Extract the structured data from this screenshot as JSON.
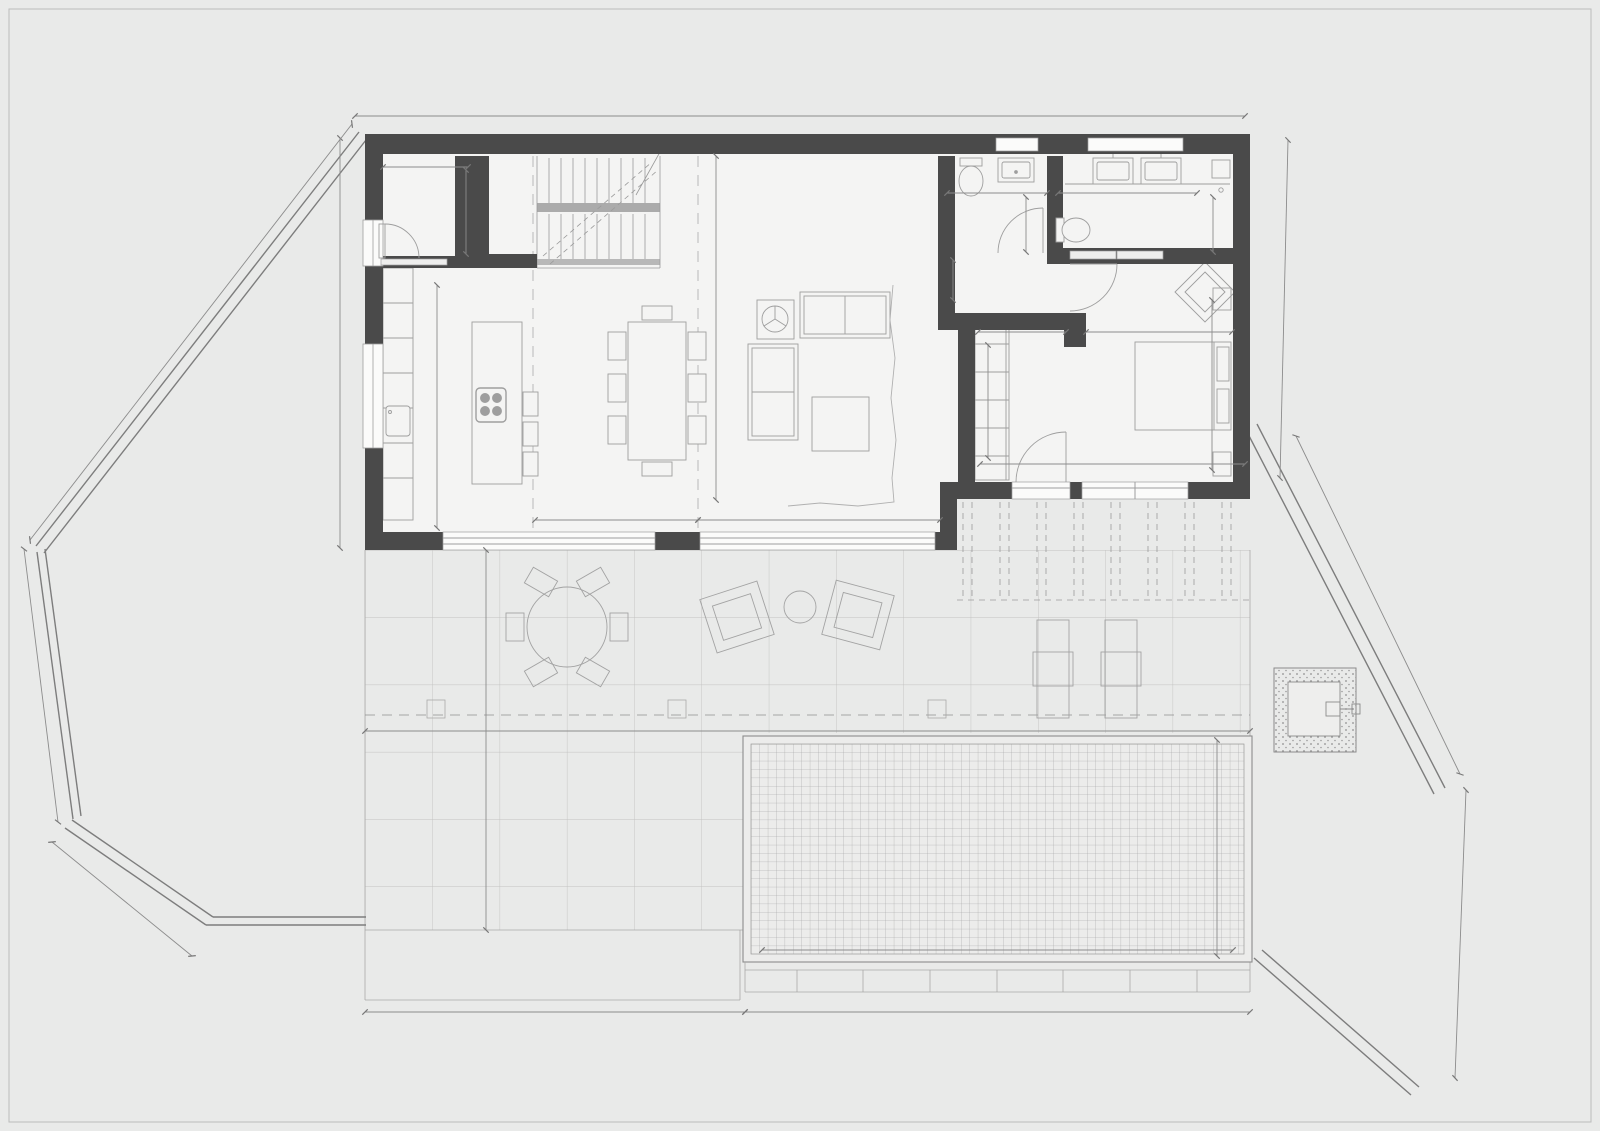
{
  "title": {
    "name": "PLANTA BAJA",
    "line1": "Sup. construida vivienda 122,3 m²",
    "line2": "Sup. construida porche 29,40 m² (computable 14,70 m²)"
  },
  "colors": {
    "title_accent": "#44708f",
    "wall": "#4a4a4a"
  },
  "rooms": {
    "despensa": {
      "name": "Despensa",
      "area": "S.útil=4,30 m²"
    },
    "escalera": {
      "name": "Escalera T1",
      "area": "S.útil=4,50 m²"
    },
    "cocina": {
      "name": "Cocina",
      "area": "S.útil=14,30 m²"
    },
    "comedor": {
      "name": "Comedor",
      "area": "S.útil=16,70 m²"
    },
    "salon": {
      "name": "Salón",
      "area": "S.útil=31,95 m²"
    },
    "paso": {
      "name": "Paso",
      "area": "S.útil=2,00 m²"
    },
    "bano1": {
      "name": "Baño 1",
      "area": "S.útil=6,30 m²"
    },
    "dormitorio1": {
      "name": "Dormitorio 1",
      "area": "S.útil=13,35 m²"
    },
    "vestidor": {
      "name": "Vestidor",
      "area": "S.útil=6,00 m²"
    },
    "terraza": {
      "name": "Terraza",
      "area": "S.útil=95,10 m²"
    },
    "piscina": {
      "name": "Piscina",
      "area": "S. lámina de agua=36,00 m²"
    }
  },
  "dims": {
    "house_top_width": "16,65",
    "house_left_height": "7,70",
    "boundary_nw": "9,64",
    "boundary_w": "5,18",
    "boundary_sw": "3,20",
    "house_right_height": "6,72",
    "boundary_e": "7,08",
    "boundary_se": "5,38",
    "terrace_width": "16,65",
    "terrace_depth": "7,00",
    "terrace_bottom_left": "7,05",
    "terrace_bottom_right": "9,60",
    "pool_width": "9,00",
    "pool_depth": "4,00",
    "despensa_width": "1,76",
    "despensa_depth": "2,00",
    "cocina_depth": "5,00",
    "comedor_window": "2,99",
    "salon_window": "4,50",
    "salon_depth": "7,10",
    "aseo_width": "1,90",
    "aseo_depth": "1,80",
    "bano_width": "3,50",
    "bano_depth": "1,80",
    "paso_depth": "1,00",
    "vestidor_width": "1,85",
    "dormitorio_width": "3,05",
    "vestidor_depth": "3,10",
    "dormitorio_depth": "4,20",
    "bedroom_block_width": "5,00"
  }
}
